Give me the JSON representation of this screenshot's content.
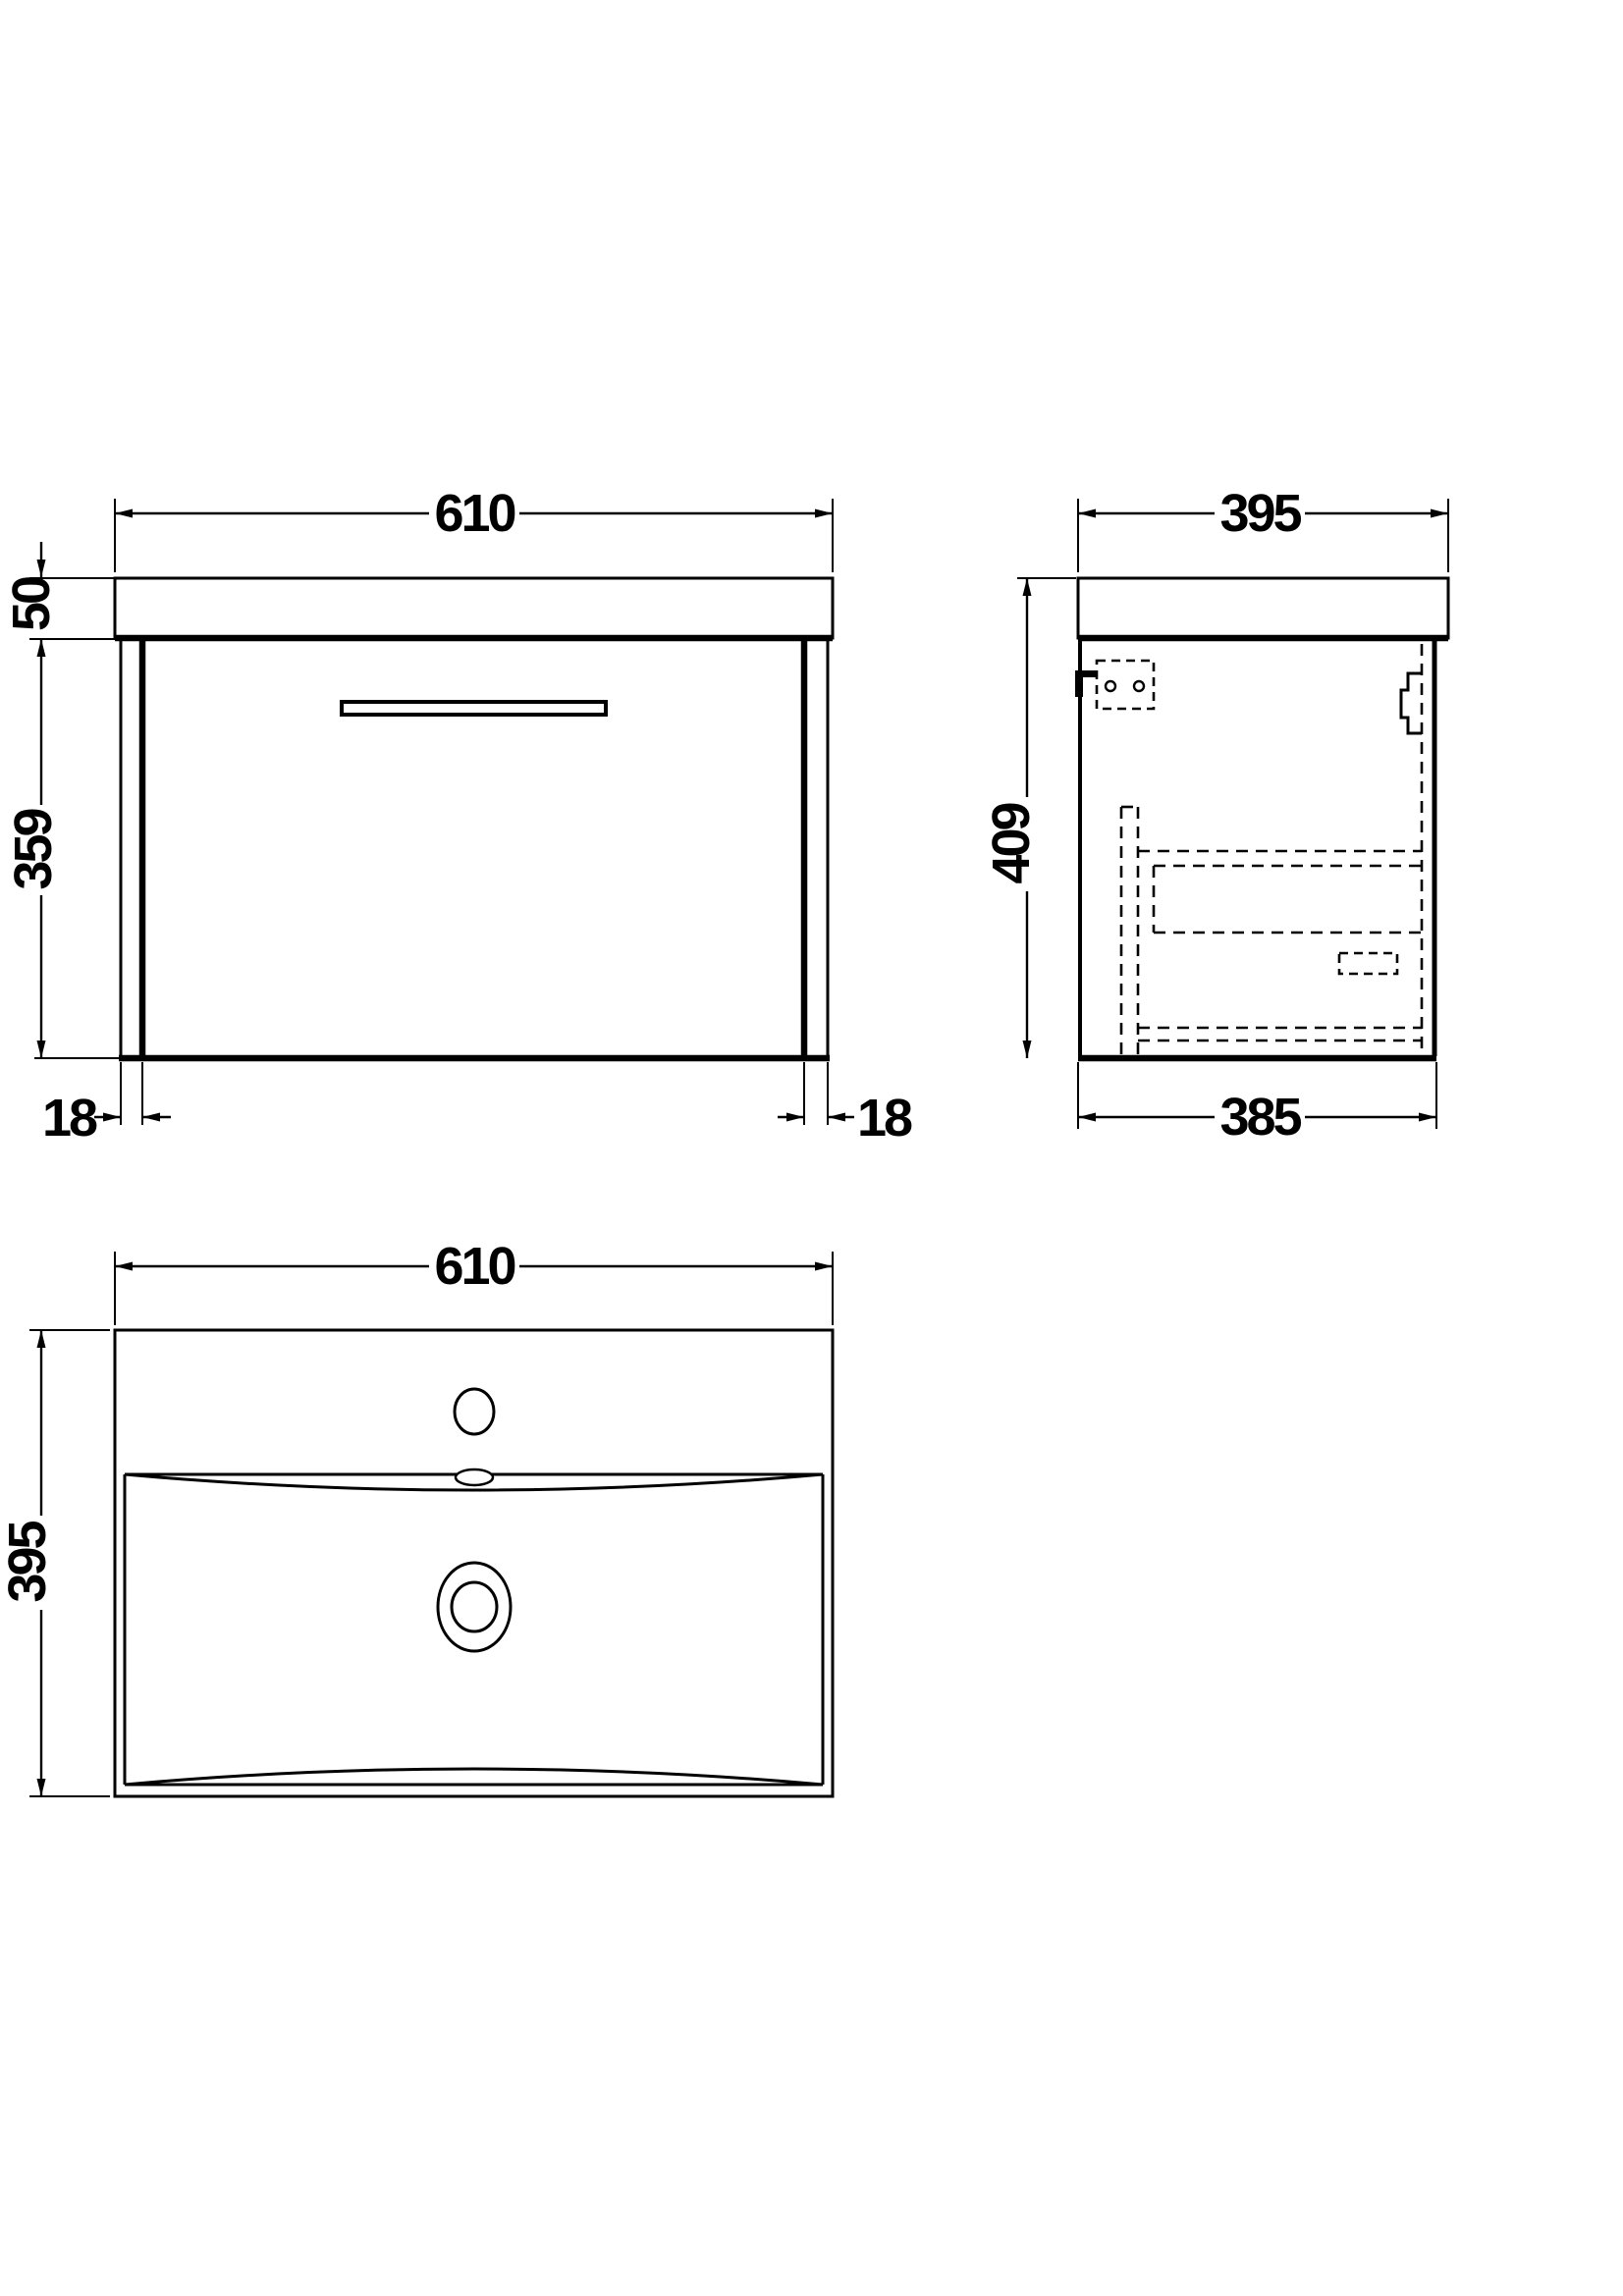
{
  "drawing": {
    "title": "vanity-unit-dimension-drawing",
    "background": "#ffffff",
    "line_color": "#000000",
    "views": [
      "front-elevation",
      "side-section",
      "basin-plan"
    ]
  },
  "dims": {
    "front_width": "610",
    "worktop": "50",
    "cabinet": "359",
    "panel_left": "18",
    "panel_right": "18",
    "side_width": "395",
    "side_height": "409",
    "side_depth": "385",
    "basin_width": "610",
    "basin_depth": "395"
  }
}
